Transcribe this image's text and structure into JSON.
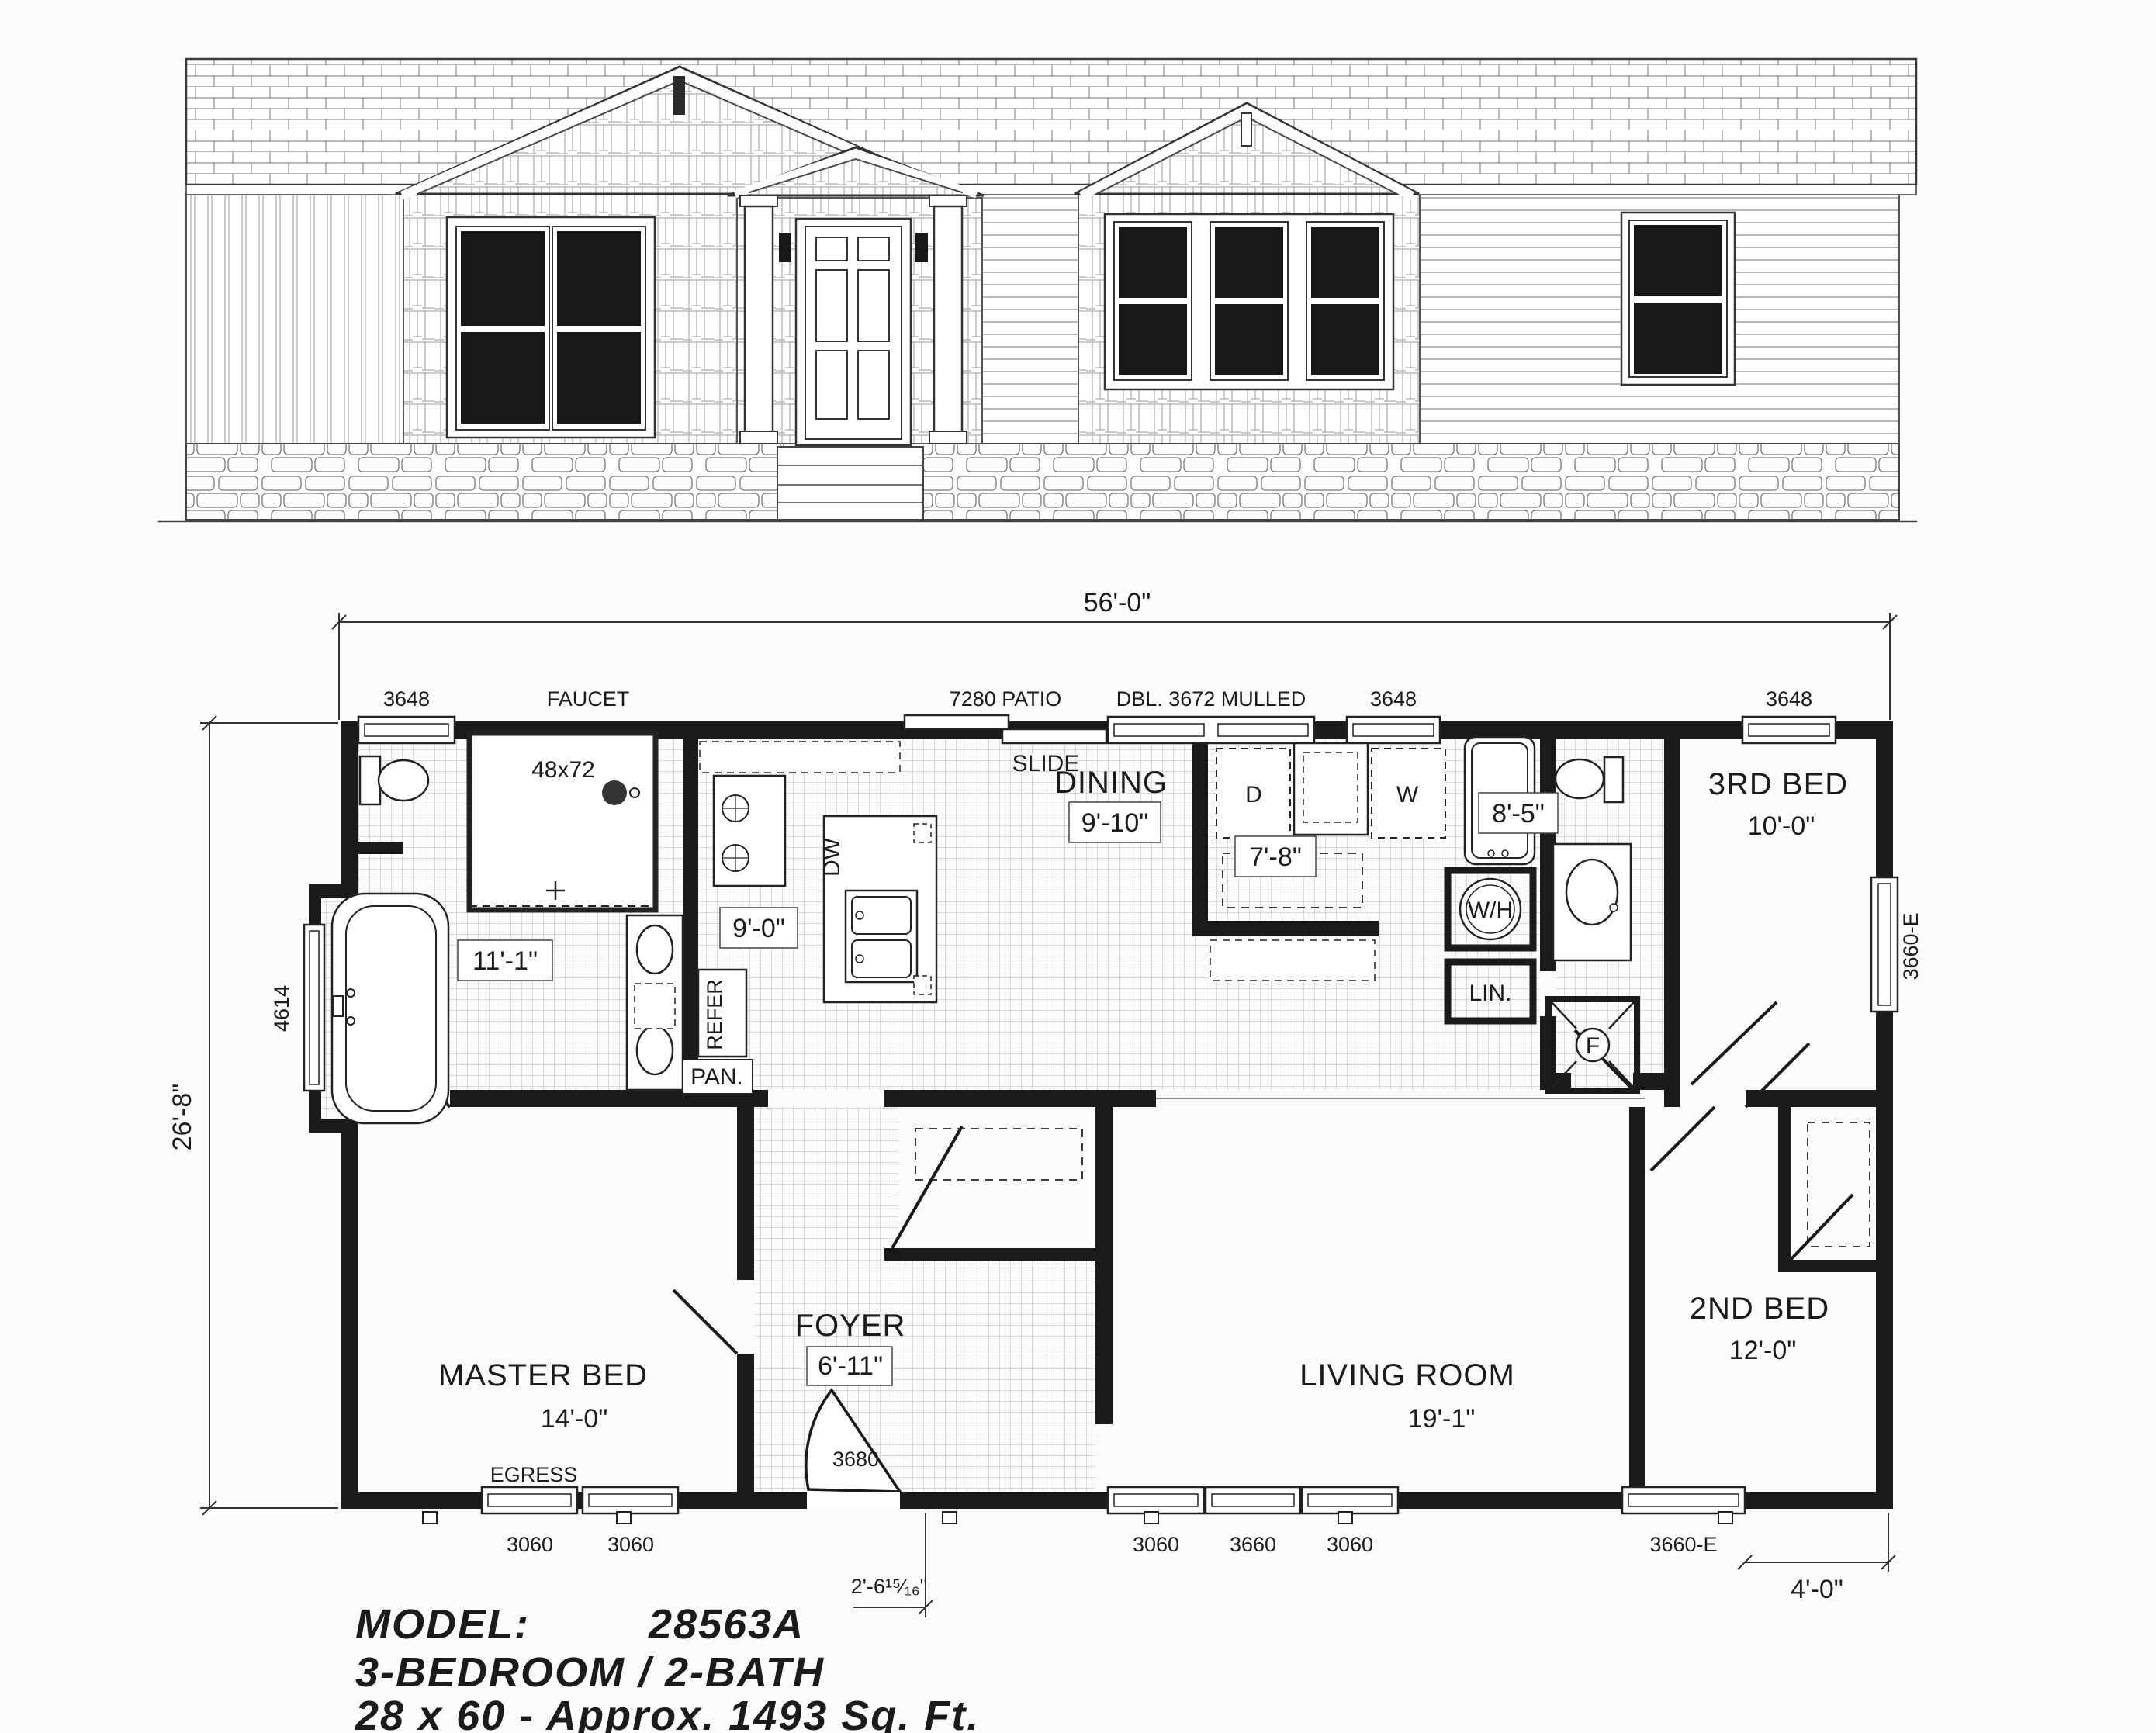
{
  "sheet": {
    "model_label": "MODEL:",
    "model_number": "28563A",
    "config": "3-BEDROOM / 2-BATH",
    "size_line": "28 x 60 - Approx. 1493 Sq. Ft."
  },
  "dimensions": {
    "overall_width": "56'-0\"",
    "overall_depth": "26'-8\"",
    "foyer_offset": "2'-6¹⁵⁄₁₆\"",
    "right_offset": "4'-0\""
  },
  "rooms": {
    "dining": {
      "name": "DINING",
      "size": "9'-10\""
    },
    "master": {
      "name": "MASTER BED",
      "size": "14'-0\""
    },
    "living": {
      "name": "LIVING ROOM",
      "size": "19'-1\""
    },
    "bed2": {
      "name": "2ND BED",
      "size": "12'-0\""
    },
    "bed3": {
      "name": "3RD BED",
      "size": "10'-0\""
    },
    "foyer": {
      "name": "FOYER",
      "size": "6'-11\""
    },
    "master_bath_size": "11'-1\"",
    "kitchen_size": "9'-0\"",
    "utility_size": "7'-8\"",
    "bath2_size": "8'-5\""
  },
  "openings": {
    "w3648": "3648",
    "w3060": "3060",
    "w3660": "3660",
    "w3660e": "3660-E",
    "w4614": "4614",
    "door3680": "3680",
    "patio": "7280 PATIO",
    "slide": "SLIDE",
    "mulled": "DBL. 3672 MULLED",
    "egress": "EGRESS",
    "faucet": "FAUCET"
  },
  "fixtures": {
    "shower": "48x72",
    "dw": "DW",
    "refer": "REFER",
    "pan": "PAN.",
    "dryer": "D",
    "washer": "W",
    "water_heater": "W/H",
    "linen": "LIN.",
    "furnace": "F"
  }
}
